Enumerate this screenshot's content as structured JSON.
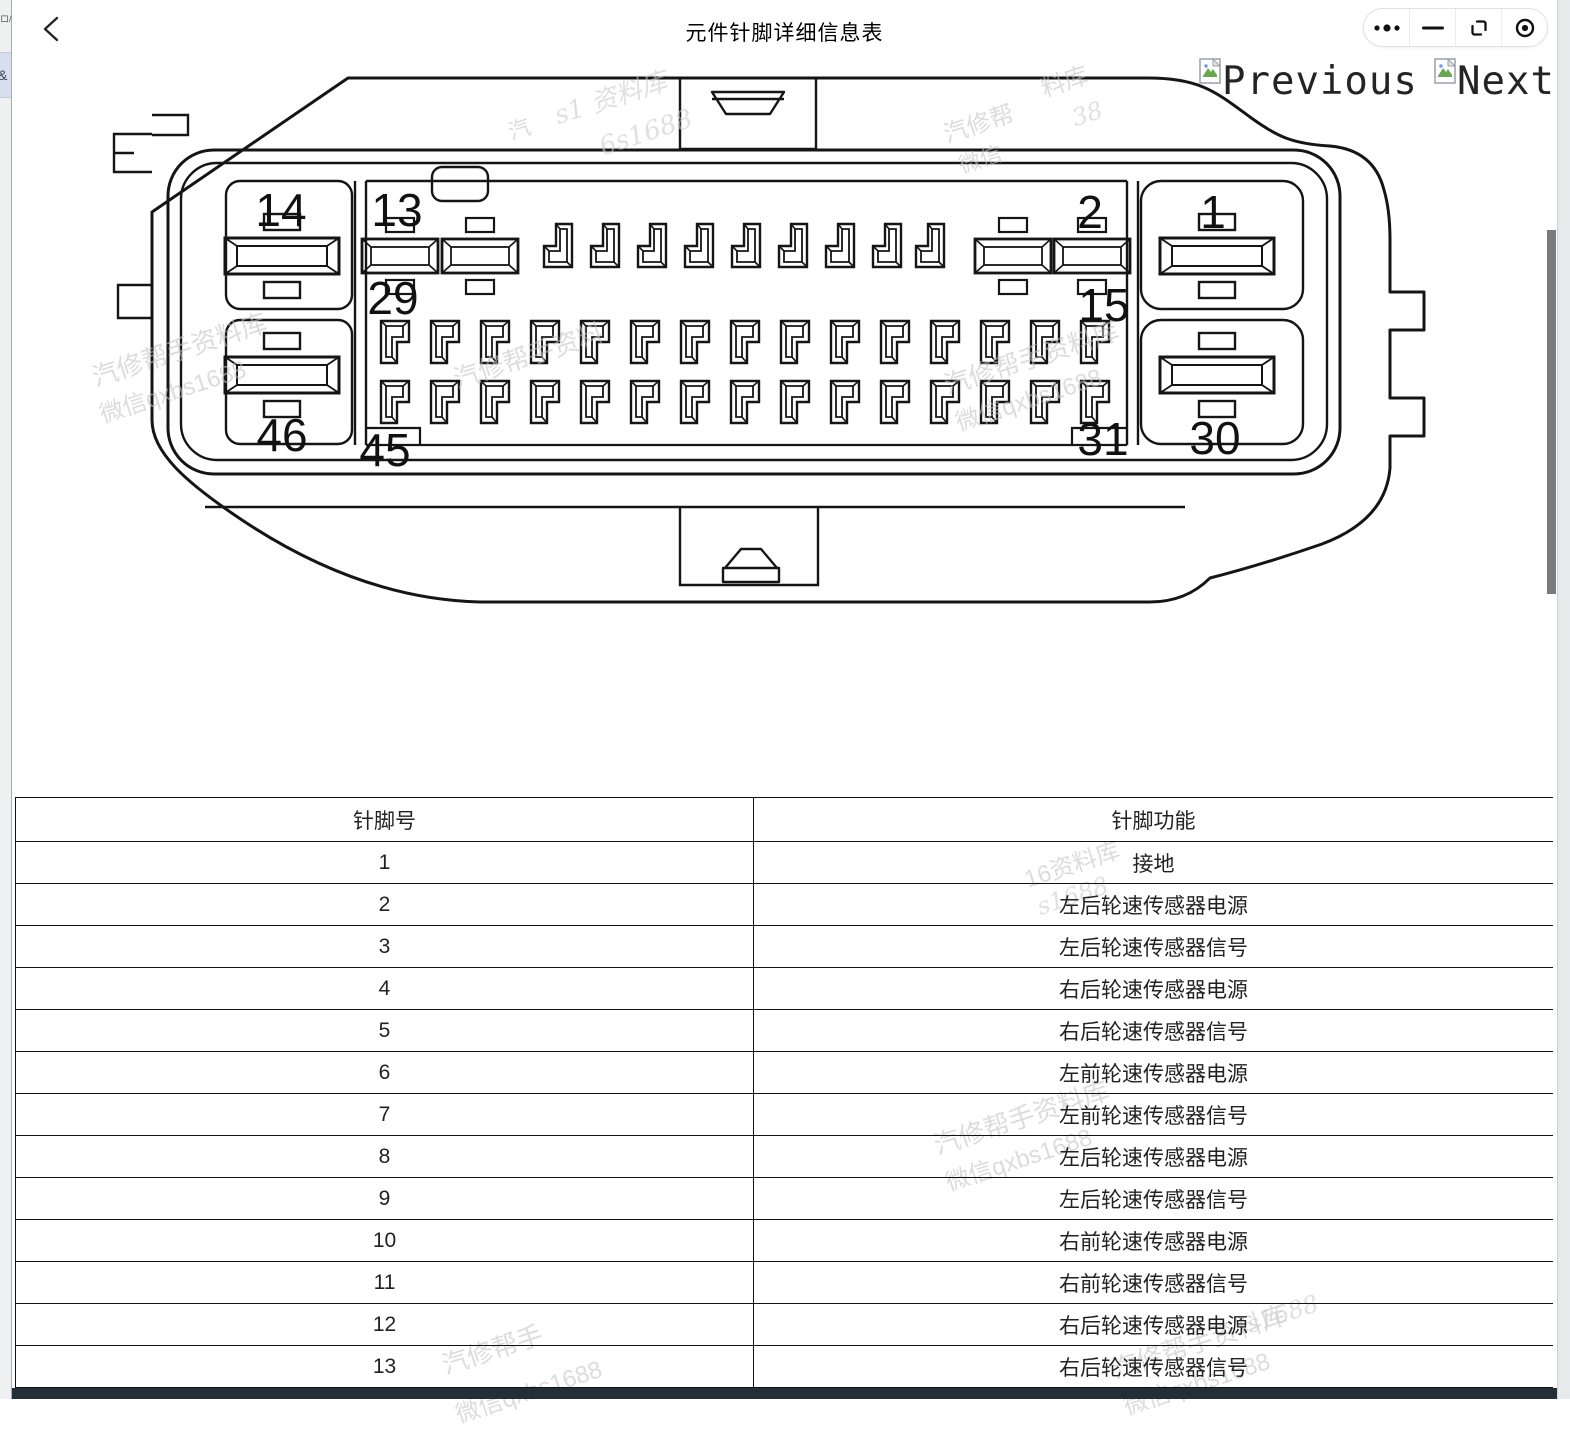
{
  "header": {
    "title": "元件针脚详细信息表"
  },
  "left_strip": {
    "frag_top": "ロ/",
    "frag_amp": "&"
  },
  "nav": {
    "previous": "Previous",
    "next": "Next"
  },
  "controls": {
    "more": "more-menu",
    "minimize": "minimize",
    "restore": "restore",
    "close": "close-circle"
  },
  "diagram": {
    "pins": {
      "p14": "14",
      "p13": "13",
      "p2": "2",
      "p1": "1",
      "p29": "29",
      "p15": "15",
      "p46": "46",
      "p45": "45",
      "p31": "31",
      "p30": "30"
    }
  },
  "watermarks": {
    "w1": "s1 资料库",
    "w2": "6s1688",
    "w3": "汽",
    "w4": "料库",
    "w5": "38",
    "w6": "汽修帮",
    "w7": "微信",
    "w8": "汽修帮手资料库",
    "w9": "微信qxbs1688",
    "w10": "汽修帮手资料",
    "w11": "汽修帮手资料库",
    "w12": "微信qxbs1688",
    "t1": "16资料库",
    "t2": "s1688",
    "t3": "汽修帮手资料库",
    "t4": "微信qxbs1688",
    "t5": "汽修帮手",
    "t6": "微信qxbs1688",
    "t7": "汽修帮手资料库",
    "t8": "微信qxbs1688",
    "t9": "s1688"
  },
  "table": {
    "headers": [
      "针脚号",
      "针脚功能"
    ],
    "rows": [
      {
        "pin": "1",
        "func": "接地"
      },
      {
        "pin": "2",
        "func": "左后轮速传感器电源"
      },
      {
        "pin": "3",
        "func": "左后轮速传感器信号"
      },
      {
        "pin": "4",
        "func": "右后轮速传感器电源"
      },
      {
        "pin": "5",
        "func": "右后轮速传感器信号"
      },
      {
        "pin": "6",
        "func": "左前轮速传感器电源"
      },
      {
        "pin": "7",
        "func": "左前轮速传感器信号"
      },
      {
        "pin": "8",
        "func": "左后轮速传感器电源"
      },
      {
        "pin": "9",
        "func": "左后轮速传感器信号"
      },
      {
        "pin": "10",
        "func": "右前轮速传感器电源"
      },
      {
        "pin": "11",
        "func": "右前轮速传感器信号"
      },
      {
        "pin": "12",
        "func": "右后轮速传感器电源"
      },
      {
        "pin": "13",
        "func": "右后轮速传感器信号"
      }
    ]
  },
  "colors": {
    "bottom_bar": "#232f38",
    "line": "#151515",
    "watermark": "#c3c3c3"
  }
}
